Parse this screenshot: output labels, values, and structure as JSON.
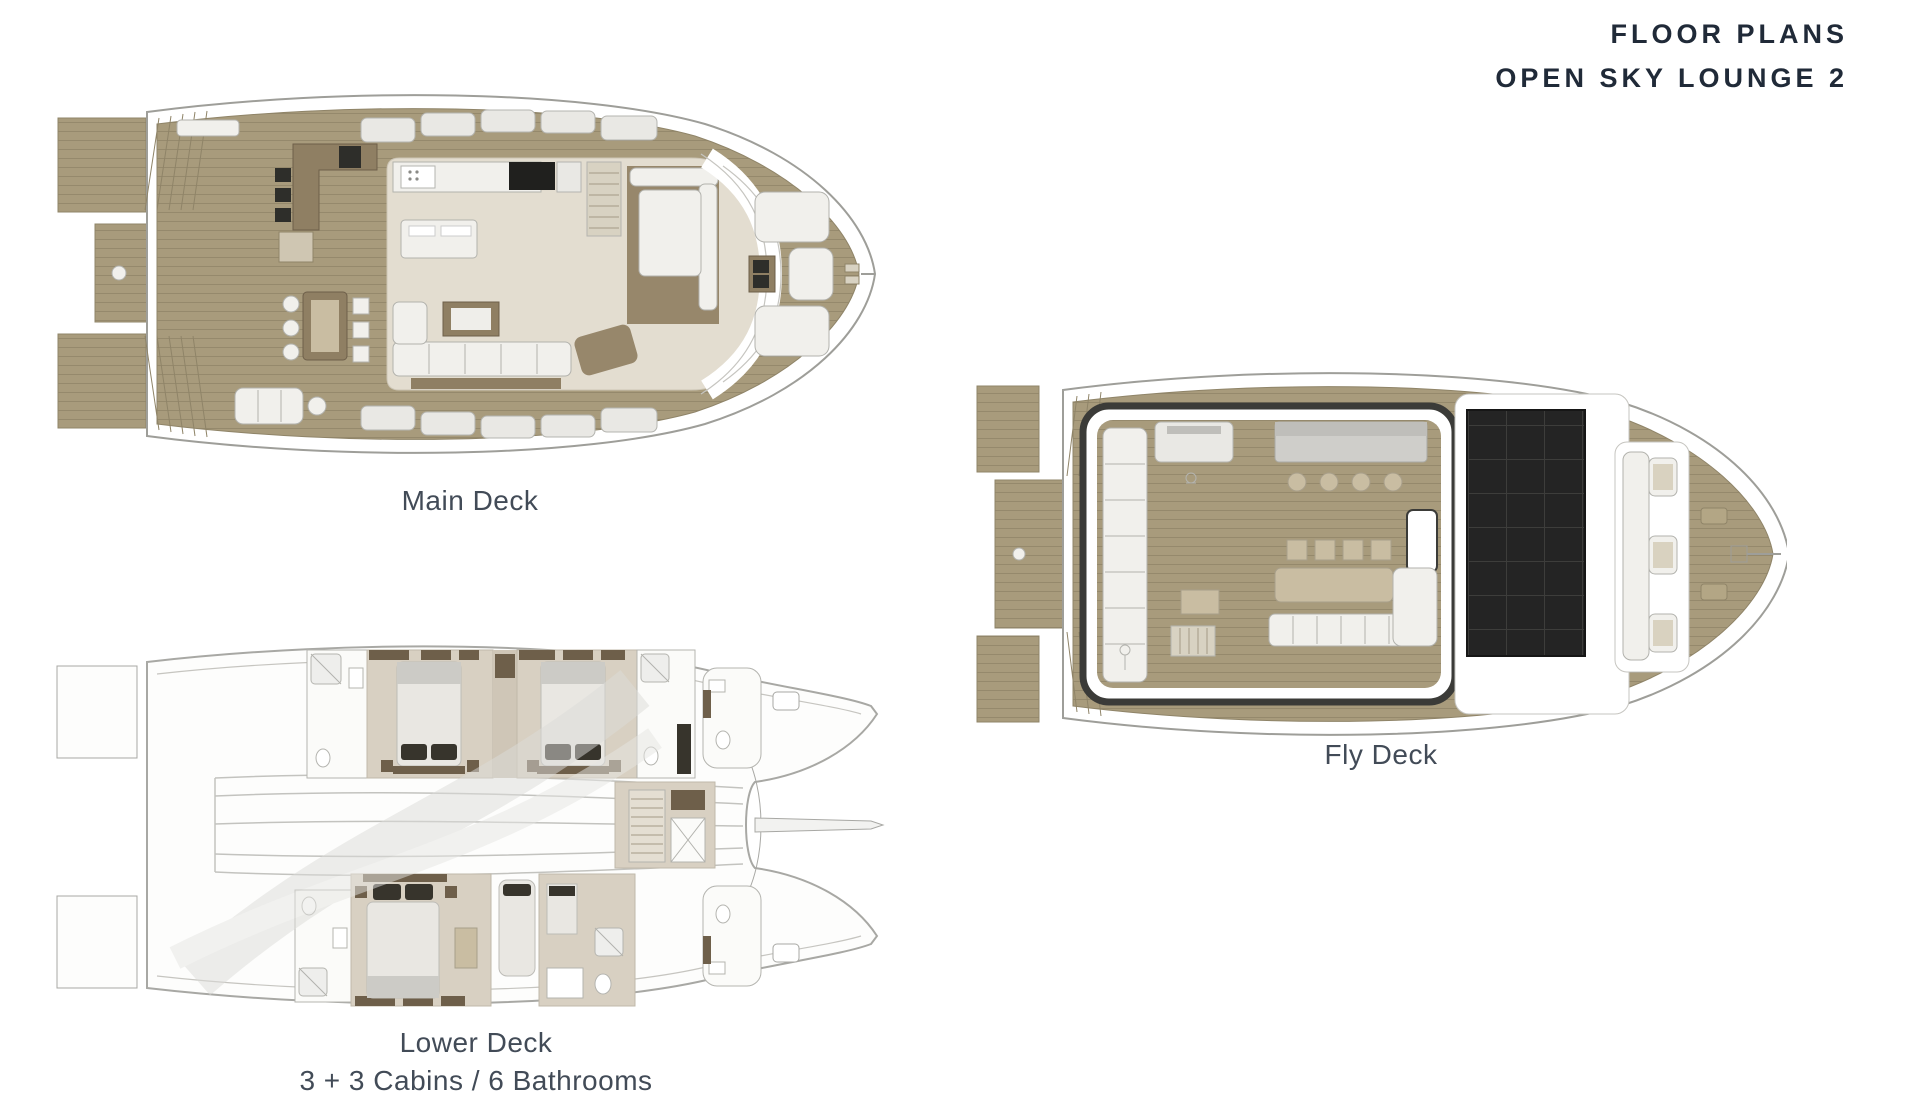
{
  "header": {
    "title_line1": "FLOOR PLANS",
    "title_line2": "OPEN SKY LOUNGE 2"
  },
  "plans": {
    "main_deck": {
      "label": "Main Deck"
    },
    "fly_deck": {
      "label": "Fly Deck"
    },
    "lower_deck": {
      "label": "Lower Deck",
      "sublabel": "3 + 3 Cabins / 6 Bathrooms"
    }
  },
  "colors": {
    "background": "#ffffff",
    "teak_deck": "#a89b7c",
    "teak_plank_line": "#93876a",
    "interior_floor": "#e3ddd0",
    "cabin_floor": "#d8d0c2",
    "furniture_white": "#f1f0ec",
    "wood_brown": "#8f7f63",
    "dark_brown": "#6e5f4a",
    "dark_accent": "#2e2e2a",
    "solar_panel": "#242424",
    "hull_outline": "#9e9e99",
    "title_text": "#202a38",
    "caption_text": "#424b57"
  }
}
